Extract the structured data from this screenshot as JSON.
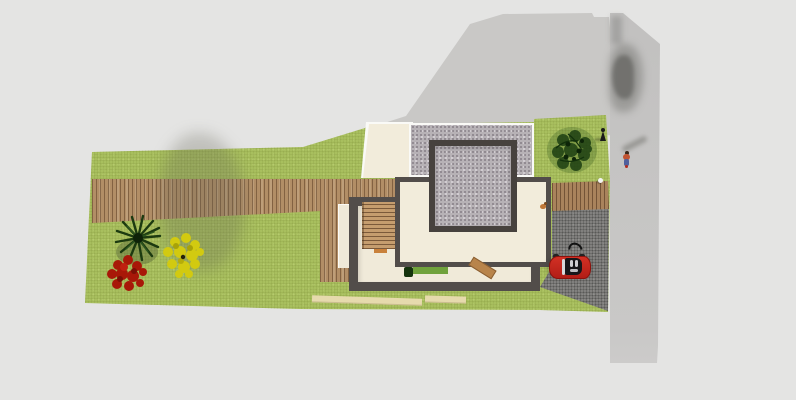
{
  "scene": {
    "name": "3d-architectural-site-plan-top-view",
    "canvas": {
      "width": 796,
      "height": 400
    },
    "description_labels": {
      "building": "two-storey flat-roof house with gravel roof lantern",
      "garden": "lawn with palm tree, red bush, yellow bush",
      "vehicle": "red convertible car on driveway",
      "figures": "person on road, statue on lawn, white ball"
    }
  },
  "colors": {
    "bg": "#e4e4e3",
    "shadow": "#c9c8c6",
    "road_top": "#c1c0bf",
    "road_mid": "#c6c5c4",
    "road_bottom": "#cfcecd",
    "lawn": "#a8bf5e",
    "wood": "#b28e66",
    "wood_right": "#a9835c",
    "cream": "#f2ecdb",
    "cream_inner": "#f0ead9",
    "patio": "#efe9d8",
    "wall": "#524d4a",
    "wall_dark": "#47423e",
    "gravel": "#b7b2b6",
    "asphalt": "#81807e",
    "white_trim": "#fafaf7",
    "stairs": "#c59d6e",
    "rug": "#70a23c",
    "bench": "#b8844b",
    "car_red": "#c5241a",
    "car_red_dark": "#8c120c",
    "cabin": "#17171a",
    "palm_green": "#1c3a10",
    "bush_red": "#a81808",
    "bush_yellow": "#d2ca10",
    "bush_dark": "#1d3f12"
  }
}
